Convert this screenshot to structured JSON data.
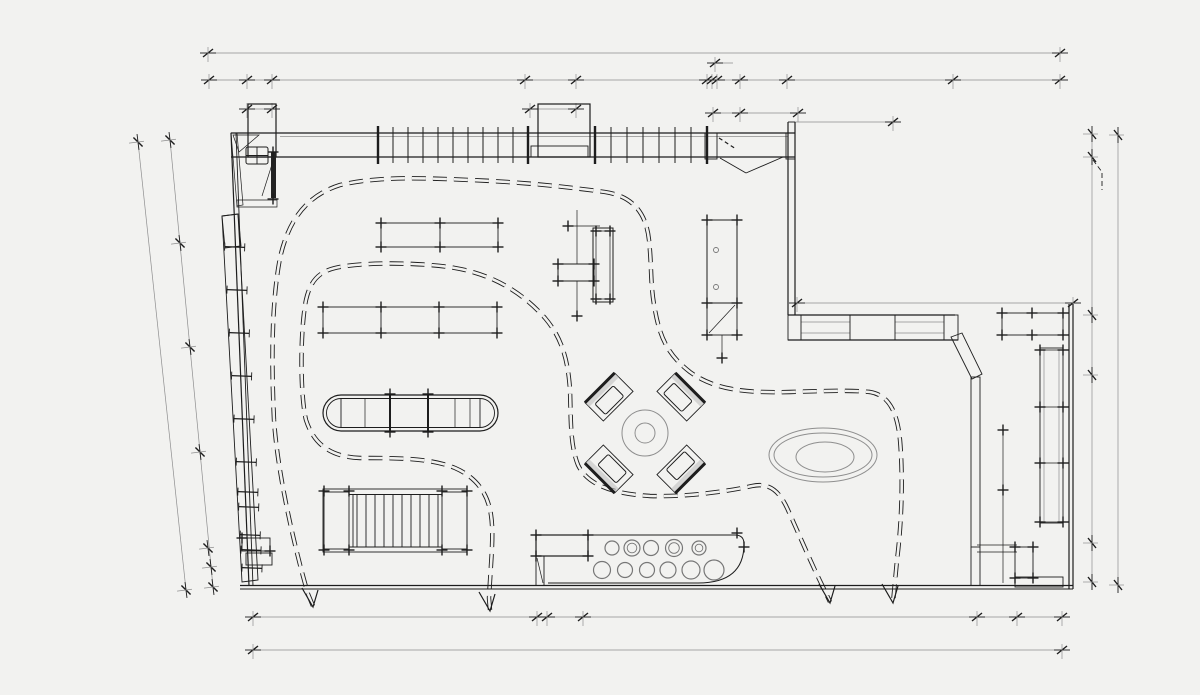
{
  "meta": {
    "type": "architectural-floor-plan",
    "view": "retail interior plan drawing, monochrome CAD linework on light gray background",
    "text_labels": []
  },
  "colors": {
    "background": "#f2f2f0",
    "line": "#1d1d1d",
    "faint": "#8e8e8e",
    "soft": "#777777",
    "shade": "#bfbfbf"
  },
  "inventory": [
    {
      "name": "top-curtain-wall",
      "desc": "glazed wall band with repeated mullions and two piers/columns"
    },
    {
      "name": "entrance-double-door",
      "desc": "angled double door leaves at top right of curtain wall"
    },
    {
      "name": "storage-room",
      "desc": "small hatched-wall room at top left with 2x2 grid table and door"
    },
    {
      "name": "left-wall-shelving",
      "desc": "slanted long shelving unit along left wall with rungs and hatched head"
    },
    {
      "name": "display-table-a",
      "desc": "rectangular display table with tick marks"
    },
    {
      "name": "display-table-b",
      "desc": "long rectangular display table with two dividers"
    },
    {
      "name": "cross-display-fixture",
      "desc": "crosshatched block with tall double-outline cabinet"
    },
    {
      "name": "tall-display-cabinet",
      "desc": "vertical cabinet with two knobs and small table below"
    },
    {
      "name": "island-pill-table",
      "desc": "capsule-shaped island table with internal dividers"
    },
    {
      "name": "garment-rack",
      "desc": "rack with hatched end blocks and hanger lines"
    },
    {
      "name": "x-seating-group",
      "desc": "four rotated lounger units around a round column"
    },
    {
      "name": "oval-rug",
      "desc": "three concentric ellipses"
    },
    {
      "name": "service-counter",
      "desc": "rounded counter with hatched block and eleven stool circles"
    },
    {
      "name": "right-wing-window-wall",
      "desc": "window wall band with hatched piers and block"
    },
    {
      "name": "fitting-wall",
      "desc": "stippled diagonal and vertical partition wall"
    },
    {
      "name": "right-wall-displays",
      "desc": "long shelving display and small cabinets on right wall"
    },
    {
      "name": "customer-flow-path",
      "desc": "two dashed double-line meander paths with four pointed arrow tips"
    },
    {
      "name": "dimension-lines",
      "desc": "architectural dimension strings on all four sides, tick marks only, no numerals"
    }
  ],
  "drawing": {
    "dim_lines": {
      "horizontal": [
        {
          "y": 53,
          "x1": 208,
          "x2": 1060,
          "ticks": [
            208,
            1060
          ]
        },
        {
          "y": 80,
          "x1": 209,
          "x2": 1060,
          "ticks": [
            209,
            247,
            272,
            525,
            576,
            707,
            712,
            717,
            740,
            787,
            953,
            1060
          ]
        },
        {
          "y": 109,
          "x1": 247,
          "x2": 272,
          "ticks": [
            247,
            272
          ]
        },
        {
          "y": 109,
          "x1": 530,
          "x2": 576,
          "ticks": [
            530,
            576
          ]
        },
        {
          "y": 113,
          "x1": 713,
          "x2": 798,
          "ticks": [
            713,
            740,
            798
          ]
        },
        {
          "y": 63,
          "x1": 712,
          "x2": 733,
          "ticks": [
            715
          ]
        },
        {
          "y": 122,
          "x1": 795,
          "x2": 893,
          "ticks": [
            893
          ]
        },
        {
          "y": 303,
          "x1": 797,
          "x2": 1073,
          "ticks": [
            797,
            1073
          ]
        },
        {
          "y": 617,
          "x1": 253,
          "x2": 1062,
          "ticks": [
            253,
            537,
            547,
            583,
            977,
            1017,
            1062
          ]
        },
        {
          "y": 650,
          "x1": 253,
          "x2": 1062,
          "ticks": [
            253,
            1062
          ]
        }
      ],
      "vertical": [
        {
          "x": 1092,
          "y1": 134,
          "y2": 590,
          "ticks": [
            134,
            157,
            315,
            375,
            543,
            582
          ]
        },
        {
          "x": 1118,
          "y1": 135,
          "y2": 585,
          "ticks": [
            135,
            585
          ]
        }
      ],
      "slanted": [
        {
          "x1": 138,
          "y1": 142,
          "x2": 186,
          "y2": 590,
          "ticks": [
            [
              138,
              142
            ],
            [
              186,
              590
            ]
          ]
        },
        {
          "x1": 170,
          "y1": 140,
          "x2": 213,
          "y2": 587,
          "ticks": [
            [
              170,
              140
            ],
            [
              180,
              243
            ],
            [
              190,
              347
            ],
            [
              200,
              452
            ],
            [
              208,
              548
            ],
            [
              211,
              567
            ],
            [
              213,
              587
            ]
          ]
        }
      ]
    },
    "mullions": {
      "groups": [
        {
          "xs": [
            378,
            393,
            408,
            423,
            438,
            453,
            468,
            483,
            498,
            513,
            528
          ]
        },
        {
          "xs": [
            595,
            611,
            627,
            643,
            659,
            675,
            691,
            707
          ]
        }
      ],
      "posts": [
        378,
        528,
        595,
        707
      ]
    },
    "shelf_rungs": {
      "ys": [
        247,
        290,
        333,
        376,
        419,
        462,
        492,
        507,
        535,
        550,
        568
      ]
    },
    "counter_stools": [
      [
        612,
        548,
        7,
        0
      ],
      [
        632,
        548,
        8,
        1
      ],
      [
        651,
        548,
        7.5,
        0
      ],
      [
        674,
        548,
        8.5,
        1
      ],
      [
        699,
        548,
        7,
        1
      ],
      [
        602,
        570,
        8.5,
        0
      ],
      [
        625,
        570,
        7.5,
        0
      ],
      [
        647,
        570,
        7.5,
        0
      ],
      [
        668,
        570,
        8,
        0
      ],
      [
        691,
        570,
        9,
        0
      ],
      [
        714,
        570,
        10,
        0
      ]
    ],
    "flow_arrows": [
      [
        313,
        607
      ],
      [
        490,
        611
      ],
      [
        830,
        603
      ],
      [
        893,
        603
      ]
    ]
  }
}
